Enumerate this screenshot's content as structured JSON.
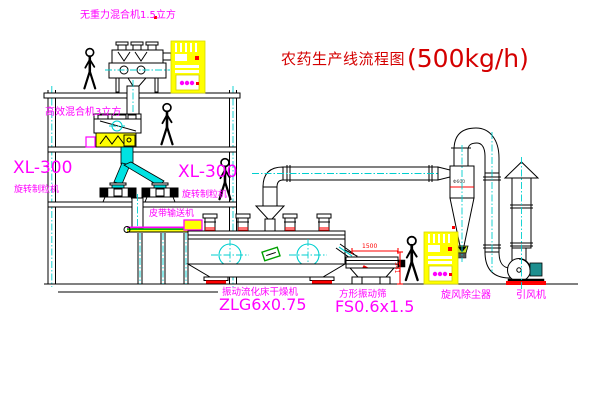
{
  "title": {
    "text": "农药生产线流程图",
    "capacity": "(500kg/h)"
  },
  "equipment_labels": {
    "gravity_mixer": "无重力混合机1.5立方",
    "high_eff_mixer": "高效混合机3立方",
    "granulator_left": {
      "model": "XL-300",
      "name": "旋转制粒机"
    },
    "granulator_right": {
      "model": "XL-300",
      "name": "旋转制粒机"
    },
    "belt_conveyor": "皮带输送机",
    "fluid_bed_dryer": {
      "name": "振动流化床干燥机",
      "model": "ZLG6x0.75"
    },
    "vibrating_sieve": {
      "name": "方形振动筛",
      "model": "FS0.6x1.5"
    },
    "cyclone": "旋风除尘器",
    "induced_draft_fan": "引风机"
  },
  "dimensions": {
    "sieve_length": "1500",
    "sieve_height": "541",
    "cyclone_dia": "Φ600"
  },
  "colors": {
    "label_magenta": "#ff00ff",
    "title_red": "#d40000",
    "dimension_red": "#ff0000",
    "centerline_cyan": "#00cfcf",
    "machine_yellow": "#ffff00",
    "motor_teal": "#1d8f8f"
  }
}
